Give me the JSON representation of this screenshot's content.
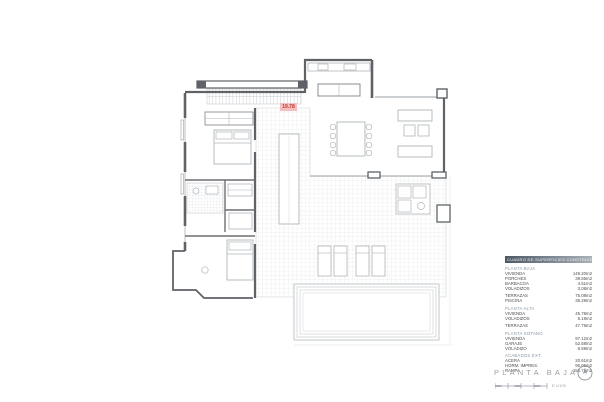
{
  "sheet": {
    "title": "PLANTA BAJA",
    "scale_label": "E 1/100"
  },
  "plan": {
    "badge": "19.78",
    "badge_color": "#c0392b",
    "rooms": [
      "dormitorio-1",
      "bano",
      "dormitorio-2",
      "dormitorio-3",
      "cocina",
      "salon-comedor",
      "terraza",
      "piscina",
      "porche"
    ]
  },
  "legend": {
    "header": "CUADRO DE SUPERFICIES CONSTRUIDAS",
    "sections": [
      {
        "title": "PLANTA BAJA",
        "rows": [
          [
            "VIVIENDA",
            "149.20m2"
          ],
          [
            "PORCHES",
            "39.65m2"
          ],
          [
            "BARBACOA",
            "4.51m2"
          ],
          [
            "VOLADIZOS",
            "3.08m2"
          ]
        ]
      },
      {
        "title": "",
        "rows": [
          [
            "TERRAZAS",
            "75.08m2"
          ],
          [
            "PISCINA",
            "35.29m2"
          ]
        ]
      },
      {
        "title": "PLANTA ALTA",
        "rows": [
          [
            "VIVIENDA",
            "45.78m2"
          ],
          [
            "VOLADIZOS",
            "5.19m2"
          ]
        ]
      },
      {
        "title": "",
        "rows": [
          [
            "TERRAZAS",
            "47.79m2"
          ]
        ]
      },
      {
        "title": "PLANTA SOTANO",
        "rows": [
          [
            "VIVIENDA",
            "97.12m2"
          ],
          [
            "GARAJE",
            "52.58m2"
          ],
          [
            "VOLADIZO",
            "8.59m2"
          ]
        ]
      },
      {
        "title": "ACABADOS EXT.",
        "rows": [
          [
            "ACERA",
            "20.61m2"
          ],
          [
            "HORM. IMPRES.",
            "95.06m2"
          ],
          [
            "RAMPA",
            "155.71m2"
          ]
        ]
      }
    ]
  },
  "colors": {
    "wall": "#5f6368",
    "light_line": "#c6cacd",
    "tile_line": "#dde0e2",
    "accent_red": "#c0392b"
  }
}
